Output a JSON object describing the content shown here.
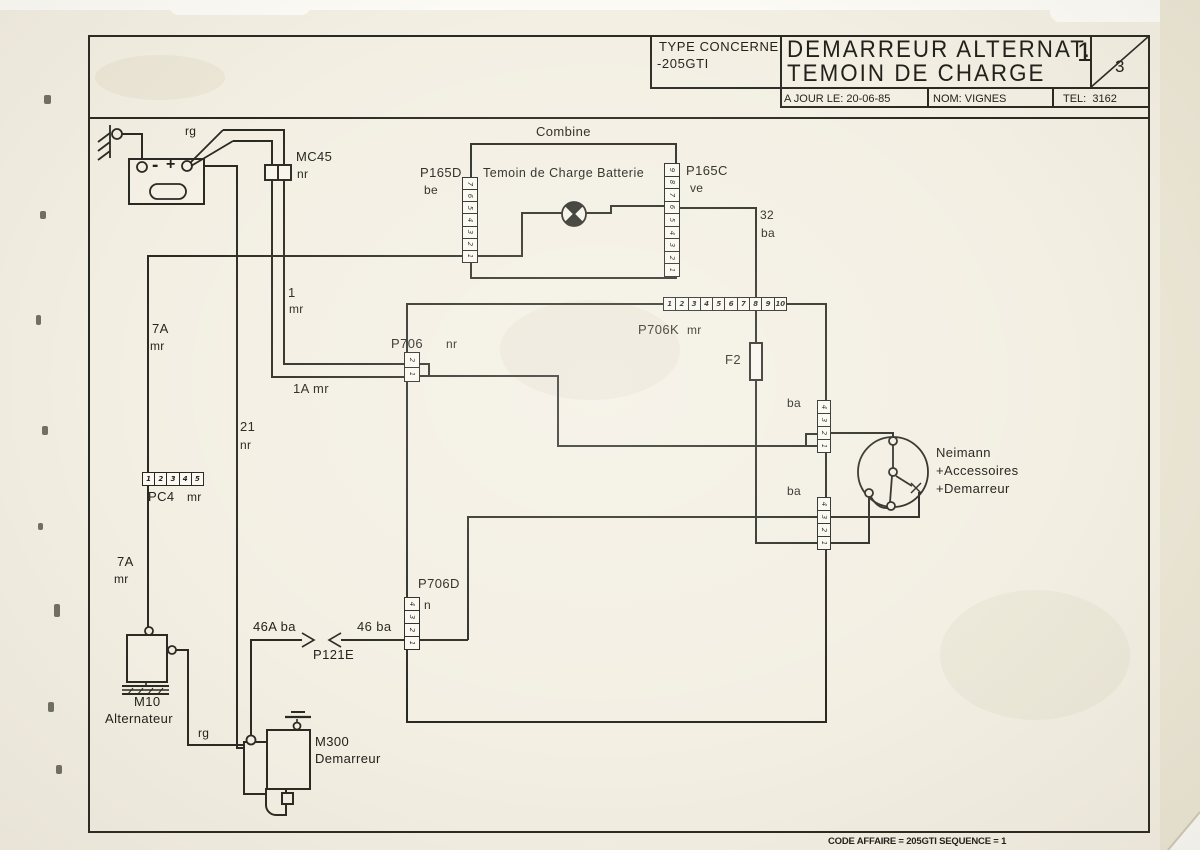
{
  "header": {
    "type_label": "TYPE CONCERNE",
    "type_value": "-205GTI",
    "title_line1": "DEMARREUR ALTERNAT.",
    "title_line2": "TEMOIN DE CHARGE",
    "page_current": "1",
    "page_total": "3",
    "updated_label": "A JOUR LE:",
    "updated_value": "20-06-85",
    "name_label": "NOM:",
    "name_value": "VIGNES",
    "tel_label": "TEL:",
    "tel_value": "3162"
  },
  "footer": {
    "code_line": "CODE AFFAIRE = 205GTI SEQUENCE = 1"
  },
  "battery": {
    "minus_sign": "-",
    "plus_sign": "+"
  },
  "connectors": {
    "mc45": {
      "name": "MC45",
      "color_code": "nr"
    },
    "p165d": {
      "name": "P165D",
      "color_code": "be",
      "pins": [
        "1",
        "2",
        "3",
        "4",
        "5",
        "6",
        "7"
      ]
    },
    "p165c": {
      "name": "P165C",
      "color_code": "ve",
      "pins": [
        "1",
        "2",
        "3",
        "4",
        "5",
        "6",
        "7",
        "8",
        "9"
      ]
    },
    "p706k": {
      "name": "P706K",
      "color_code": "mr",
      "pins": [
        "1",
        "2",
        "3",
        "4",
        "5",
        "6",
        "7",
        "8",
        "9",
        "10"
      ]
    },
    "p706": {
      "name": "P706",
      "color_code": "nr",
      "pins": [
        "1",
        "2"
      ]
    },
    "p706d": {
      "name": "P706D",
      "color_code": "n",
      "pins": [
        "1",
        "2",
        "3",
        "4"
      ]
    },
    "pc4": {
      "name": "PC4",
      "color_code": "mr",
      "pins": [
        "1",
        "2",
        "3",
        "4",
        "5"
      ]
    },
    "neimann_upper": {
      "color_code": "ba",
      "pins": [
        "1",
        "2",
        "3",
        "4"
      ]
    },
    "neimann_lower": {
      "color_code": "ba",
      "pins": [
        "1",
        "2",
        "3",
        "4"
      ]
    },
    "p121e": {
      "name": "P121E"
    }
  },
  "components": {
    "combine": {
      "name": "Combine",
      "lamp_label": "Temoin de Charge Batterie"
    },
    "fuse": {
      "name": "F2"
    },
    "neimann": {
      "name": "Neimann",
      "position2": "+Accessoires",
      "position3": "+Demarreur"
    },
    "alternator": {
      "code": "M10",
      "name": "Alternateur"
    },
    "starter": {
      "code": "M300",
      "name": "Demarreur"
    }
  },
  "wires": {
    "rg_top": "rg",
    "rg_bottom": "rg",
    "w7a_a": "7A",
    "w7a_a2": "mr",
    "w7a_b": "7A",
    "w7a_b2": "mr",
    "w21": "21",
    "w21_2": "nr",
    "w1": "1",
    "w1_2": "mr",
    "w1a": "1A mr",
    "w32": "32",
    "w32_2": "ba",
    "w46a": "46A ba",
    "w46": "46 ba",
    "ba_upper": "ba",
    "ba_lower": "ba"
  }
}
